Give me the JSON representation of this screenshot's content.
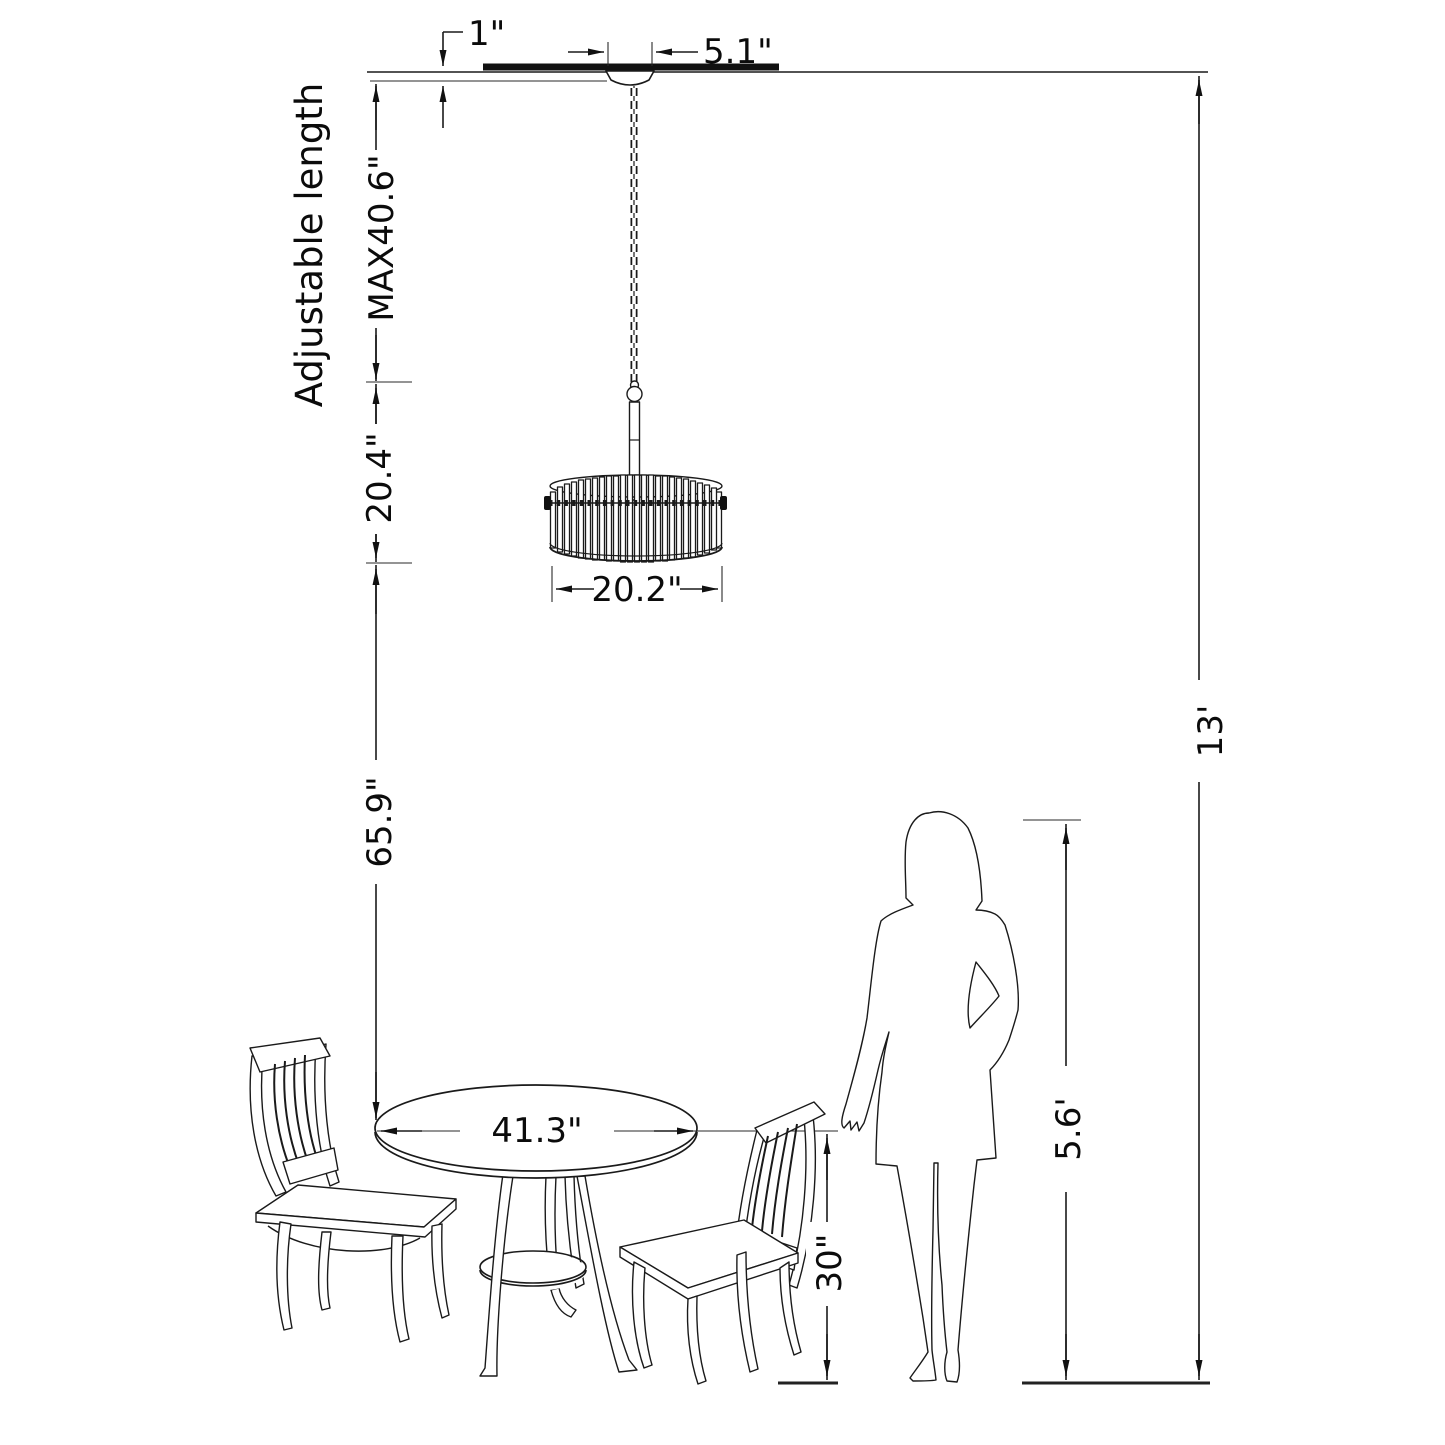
{
  "diagram": {
    "type": "product-dimension-drawing",
    "subject": "drum chandelier above round dining table with two chairs and person for scale",
    "colors": {
      "background": "#ffffff",
      "line": "#1a1a1a"
    },
    "labels": {
      "canopy_drop": "1\"",
      "canopy_width": "5.1\"",
      "adjustable_length": "Adjustable length",
      "max_length": "MAX40.6\"",
      "chain_section": "20.4\"",
      "shade_diameter": "20.2\"",
      "shade_to_table": "65.9\"",
      "ceiling_height": "13'",
      "person_height": "5.6'",
      "table_height": "30\"",
      "table_diameter": "41.3\""
    }
  }
}
